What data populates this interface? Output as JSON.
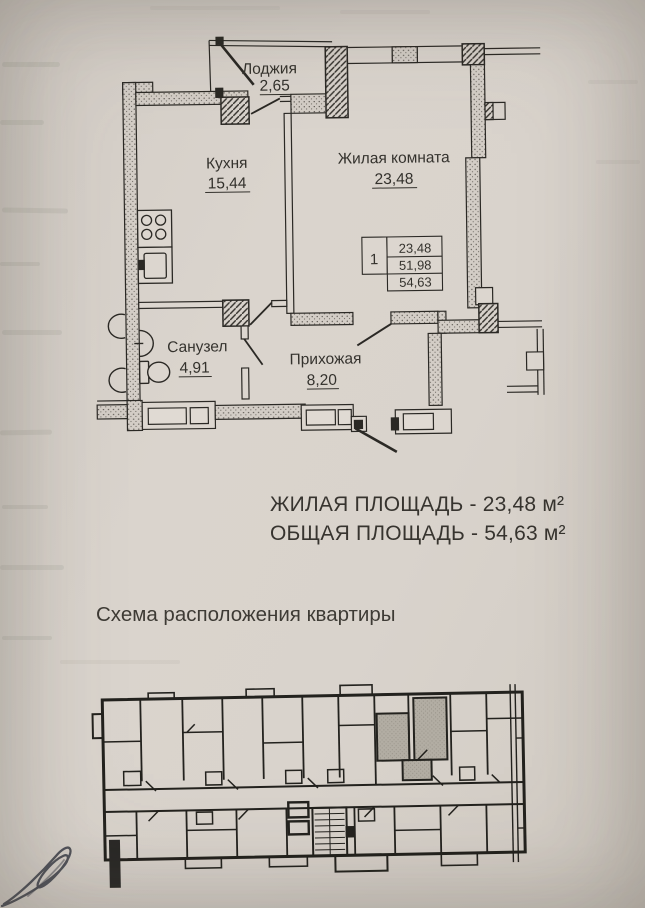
{
  "plan": {
    "rooms": [
      {
        "name": "Лоджия",
        "area": "2,65"
      },
      {
        "name": "Кухня",
        "area": "15,44"
      },
      {
        "name": "Жилая комната",
        "area": "23,48"
      },
      {
        "name": "Санузел",
        "area": "4,91"
      },
      {
        "name": "Прихожая",
        "area": "8,20"
      }
    ],
    "stamp": {
      "rooms_count": "1",
      "row1": "23,48",
      "row2": "51,98",
      "row3": "54,63"
    }
  },
  "summary": {
    "living_area_line": "ЖИЛАЯ ПЛОЩАДЬ - 23,48 м²",
    "total_area_line": "ОБЩАЯ ПЛОЩАДЬ - 54,63 м²"
  },
  "section_heading": "Схема расположения квартиры",
  "colors": {
    "paper": "#d8d2cb",
    "ink": "#2b2925",
    "text": "#393631",
    "apartment_highlight": "#b2ada3"
  }
}
